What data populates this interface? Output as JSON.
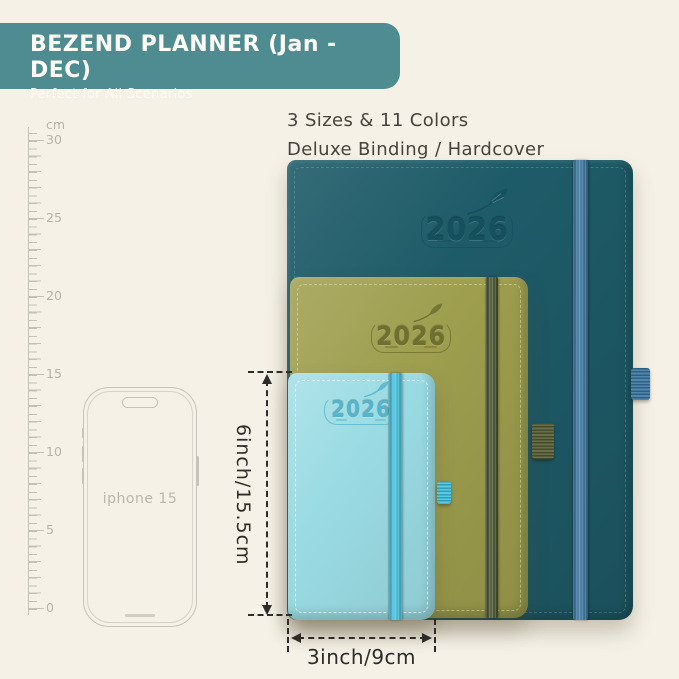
{
  "banner": {
    "title": "BEZEND PLANNER (Jan - DEC)",
    "subtitle": "Perfect for All Scenarios"
  },
  "headline": {
    "line1": "3 Sizes & 11 Colors",
    "line2": "Deluxe Binding / Hardcover"
  },
  "ruler": {
    "unit": "cm",
    "labels": [
      "30",
      "25",
      "20",
      "15",
      "10",
      "5",
      "0"
    ]
  },
  "phone": {
    "label": "iphone 15"
  },
  "planners": [
    {
      "size": "large",
      "year": "2026"
    },
    {
      "size": "medium",
      "year": "2026"
    },
    {
      "size": "small",
      "year": "2026"
    }
  ],
  "dimensions": {
    "height_label": "6inch/15.5cm",
    "width_label": "3inch/9cm"
  },
  "colors": {
    "bg": "#f5f1e7",
    "banner": "#4f8c92",
    "banner-text": "#fdfcf5",
    "ink": "#45433c",
    "ruler": "#c4c1b8",
    "ruler-text": "#b7b4ab",
    "phone": "#c6c3ba",
    "phone-text": "#b9b6ad",
    "cover-large": "#1e5b68",
    "band-large": "#3d7aa6",
    "emboss-large": "#14505d",
    "cover-medium": "#9e9e4e",
    "band-medium": "#47532f",
    "emboss-medium": "#6f7030",
    "loop-medium": "#5a6139",
    "cover-small": "#9adbe3",
    "band-small": "#45c6e4",
    "emboss-small": "#55b5cc",
    "dim": "#2e2c28"
  }
}
